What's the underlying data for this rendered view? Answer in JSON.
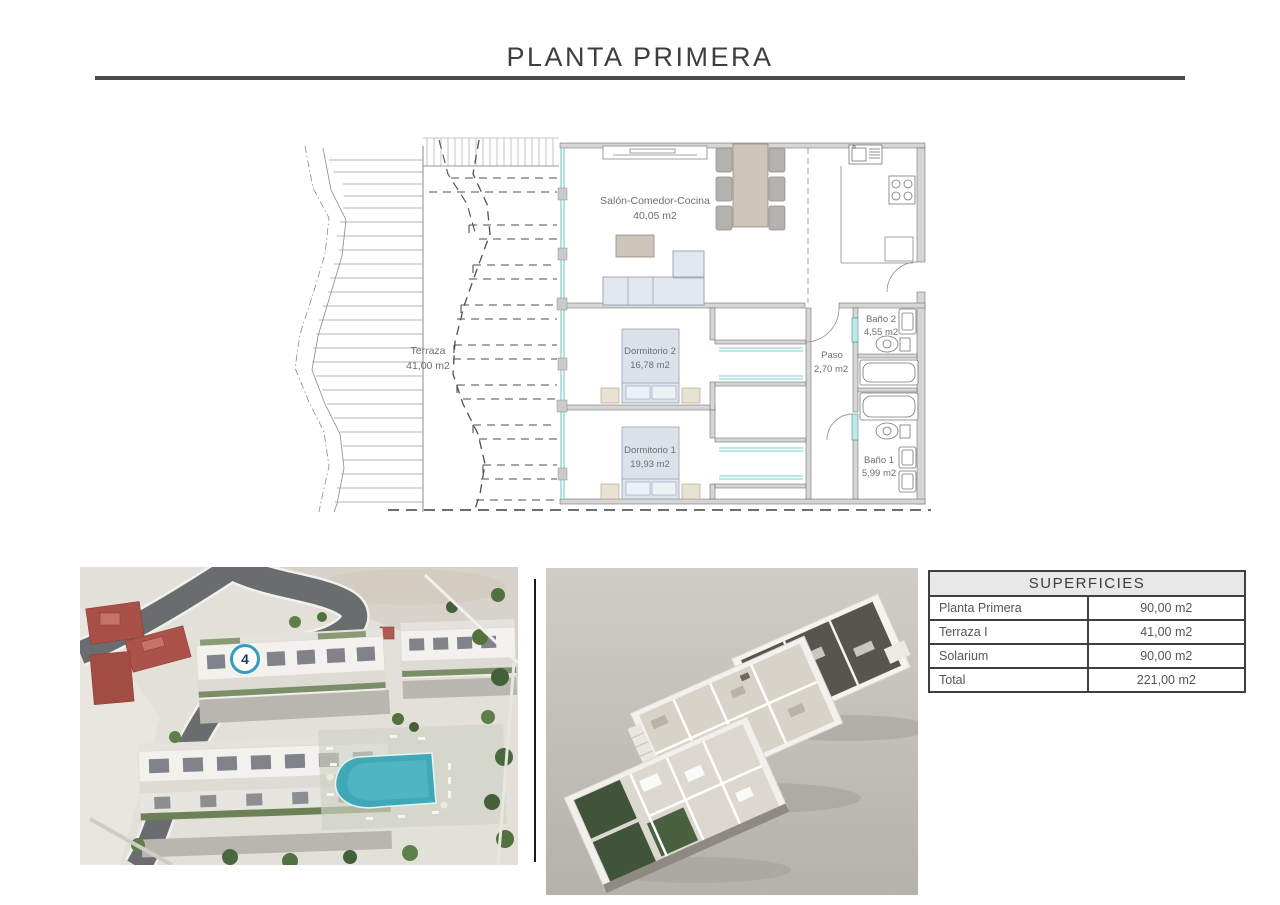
{
  "page": {
    "title": "PLANTA PRIMERA"
  },
  "floor_plan": {
    "rooms": [
      {
        "name": "Salón-Comedor-Cocina",
        "area": "40,05 m2"
      },
      {
        "name": "Terraza",
        "area": "41,00 m2"
      },
      {
        "name": "Dormitorio 2",
        "area": "16,78 m2"
      },
      {
        "name": "Dormitorio 1",
        "area": "19,93 m2"
      },
      {
        "name": "Baño 2",
        "area": "4,55 m2"
      },
      {
        "name": "Paso",
        "area": "2,70 m2"
      },
      {
        "name": "Baño 1",
        "area": "5,99 m2"
      }
    ]
  },
  "site_plan": {
    "unit_marker": "4"
  },
  "superficies_table": {
    "title": "SUPERFICIES",
    "rows": [
      {
        "label": "Planta Primera",
        "value": "90,00 m2"
      },
      {
        "label": "Terraza I",
        "value": "41,00 m2"
      },
      {
        "label": "Solarium",
        "value": "90,00 m2"
      },
      {
        "label": "Total",
        "value": "221,00 m2"
      }
    ]
  },
  "colors": {
    "line_dark": "#4a4a4d",
    "wall_gray": "#d6d6d6",
    "glass_teal": "#7fcfcb",
    "furniture_tan": "#cdc4ba",
    "furniture_blue": "#e3e8ef",
    "badge_ring": "#2d9ec2",
    "pool": "#3fa9b8"
  }
}
